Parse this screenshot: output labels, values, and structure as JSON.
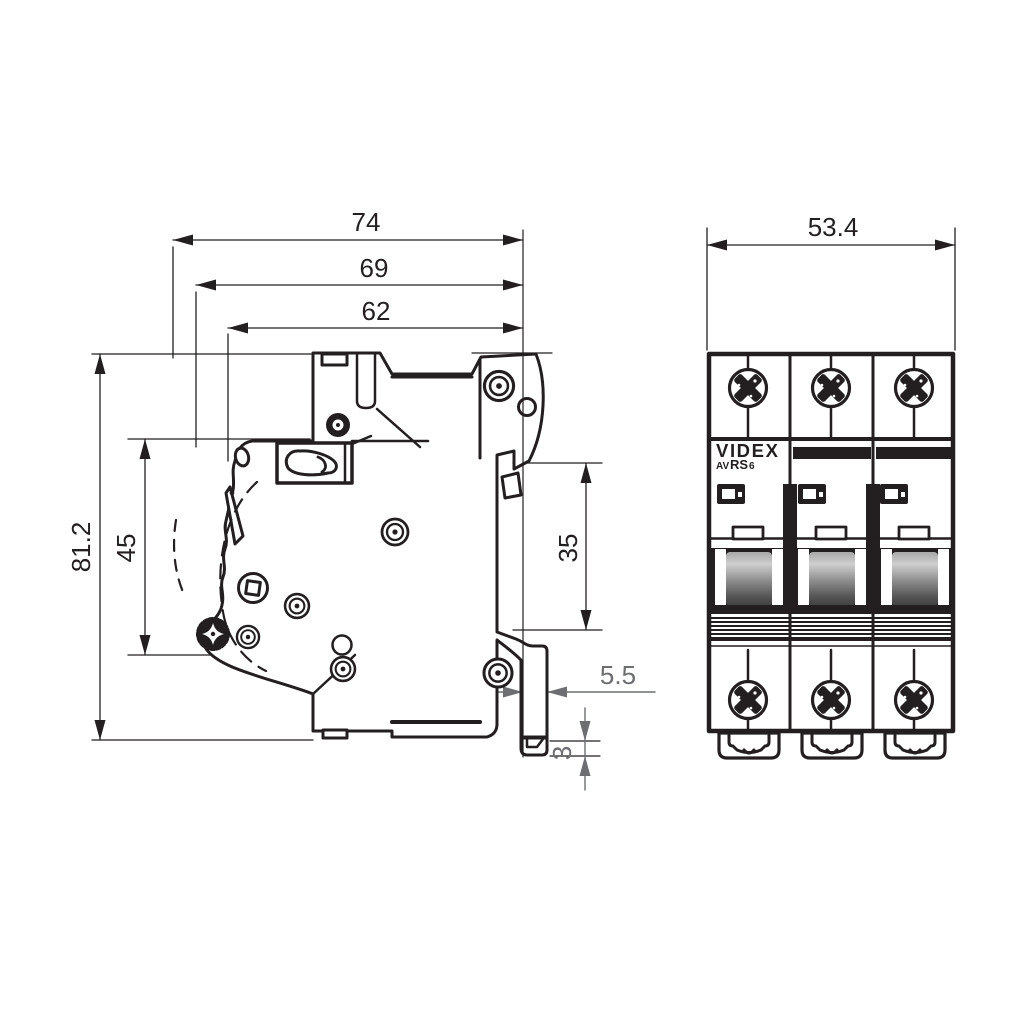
{
  "colors": {
    "ink": "#231f20",
    "dim_secondary": "#6d6e71",
    "background": "#ffffff",
    "lever_light": "#cfcfcf",
    "lever_mid": "#8a8a8a",
    "lever_dark": "#3f3f3f"
  },
  "dimensions": {
    "side": {
      "d74": "74",
      "d69": "69",
      "d62": "62",
      "d81_2": "81.2",
      "d45": "45",
      "d35": "35",
      "d5_5": "5.5",
      "d3": "3"
    },
    "front": {
      "d53_4": "53.4"
    }
  },
  "branding": {
    "logo": "VIDEX",
    "model_prefix": "AV",
    "model_series": "RS",
    "model_rating": "6"
  }
}
